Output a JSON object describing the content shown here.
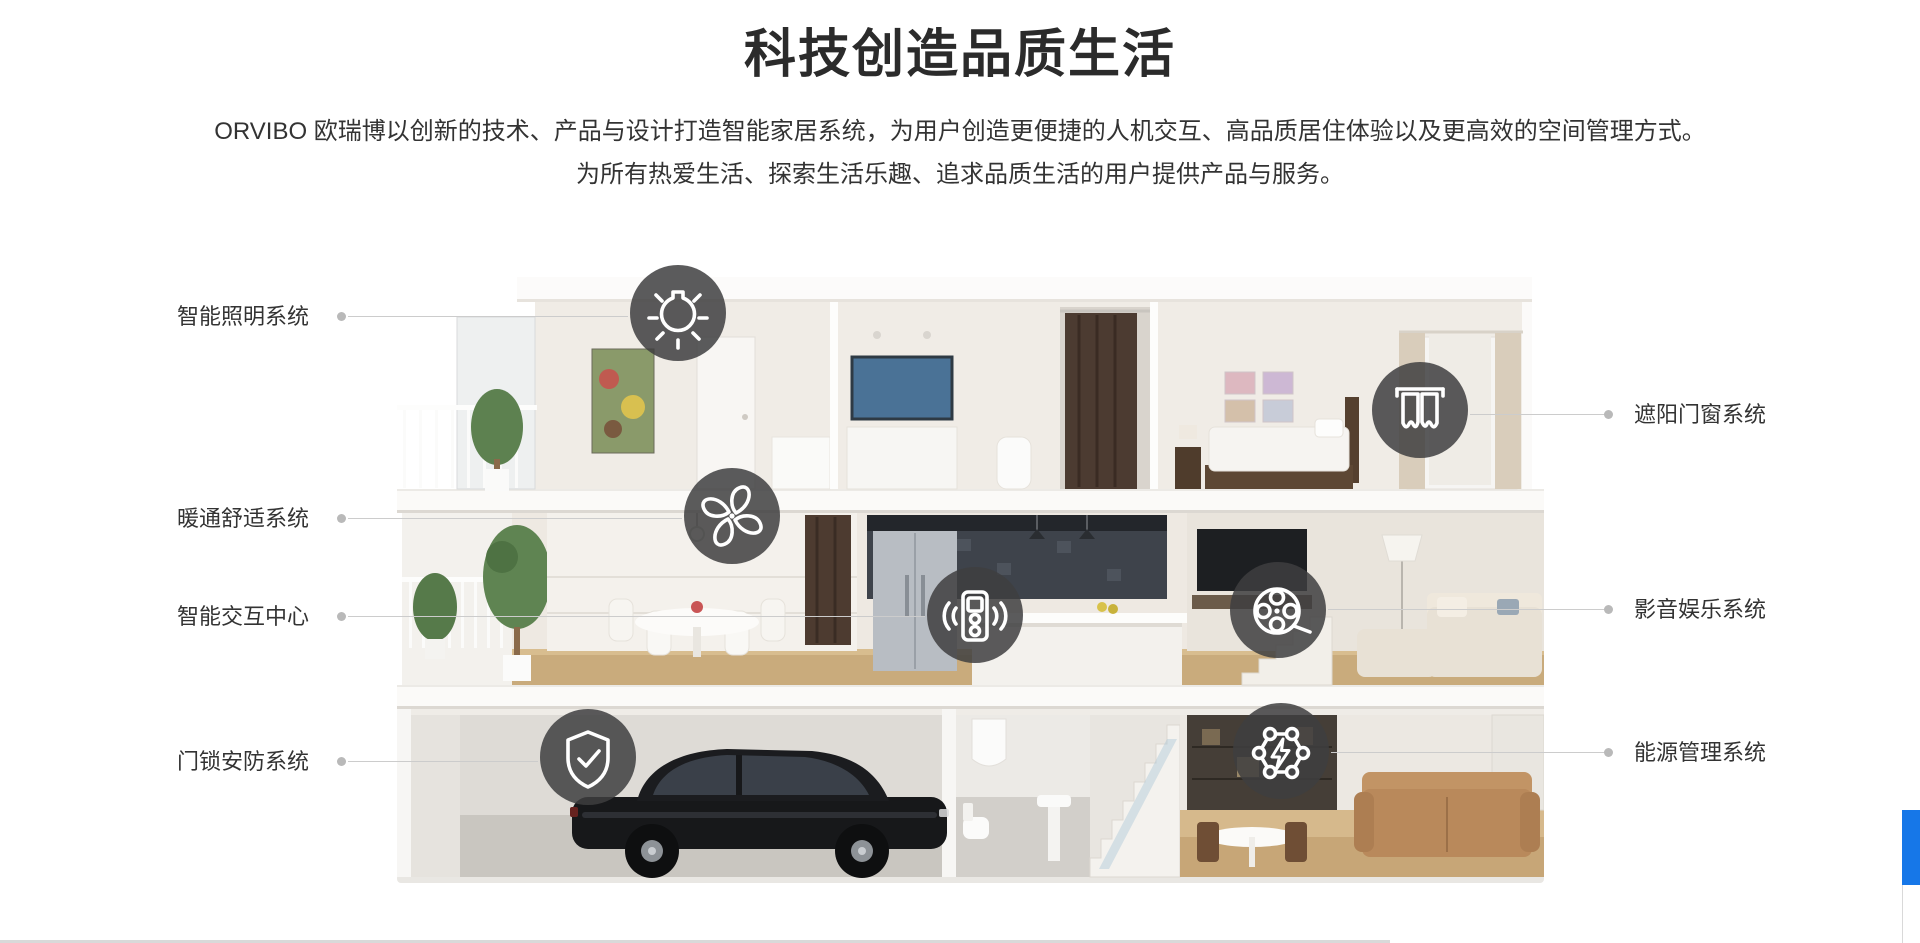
{
  "header": {
    "title": "科技创造品质生活",
    "description_line1": "ORVIBO 欧瑞博以创新的技术、产品与设计打造智能家居系统，为用户创造更便捷的人机交互、高品质居住体验以及更高效的空间管理方式。",
    "description_line2": "为所有热爱生活、探索生活乐趣、追求品质生活的用户提供产品与服务。"
  },
  "systems": {
    "left": [
      {
        "label": "智能照明系统",
        "icon": "bulb-icon"
      },
      {
        "label": "暖通舒适系统",
        "icon": "fan-icon"
      },
      {
        "label": "智能交互中心",
        "icon": "remote-control-icon"
      },
      {
        "label": "门锁安防系统",
        "icon": "shield-check-icon"
      }
    ],
    "right": [
      {
        "label": "遮阳门窗系统",
        "icon": "curtain-icon"
      },
      {
        "label": "影音娱乐系统",
        "icon": "film-reel-icon"
      },
      {
        "label": "能源管理系统",
        "icon": "energy-network-icon"
      }
    ]
  },
  "illustration": {
    "subject": "三层智能家居剖面图（车库黑色轿车、餐厨、客厅、卧室）"
  },
  "colors": {
    "accent_blue": "#1677e8",
    "heading_text": "#2b2b2b",
    "body_text": "#333333",
    "label_text": "#333333",
    "connector_line": "#cccccc",
    "connector_dot": "#b9b9b9",
    "icon_circle": "rgba(62,62,64,0.85)",
    "icon_glyph": "#ffffff",
    "icon_node": "#454547",
    "divider_gray": "#d9d9d9"
  }
}
